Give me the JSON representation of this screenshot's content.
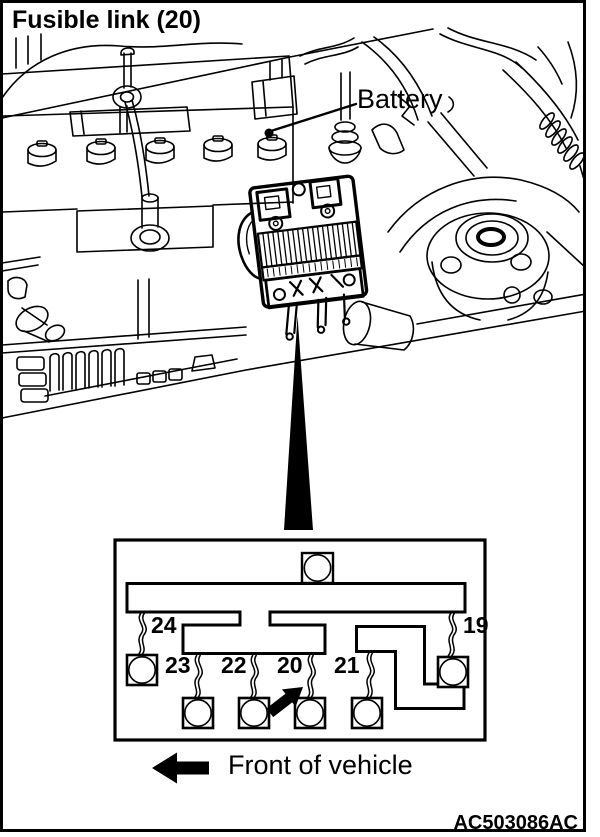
{
  "title": "Fusible link (20)",
  "callout": {
    "battery": "Battery"
  },
  "detail_box": {
    "fuse_positions": {
      "p24": "24",
      "p23": "23",
      "p22": "22",
      "p20": "20",
      "p21": "21",
      "p19": "19"
    },
    "highlighted_position": "20"
  },
  "footer": {
    "front_of_vehicle": "Front of vehicle",
    "figure_code": "AC503086AC"
  },
  "colors": {
    "ink": "#000000",
    "paper": "#ffffff"
  }
}
